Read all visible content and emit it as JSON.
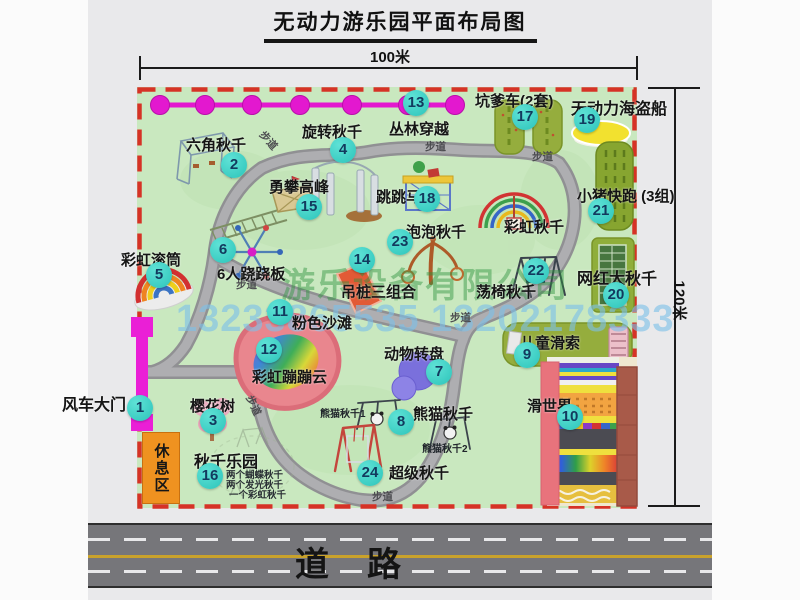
{
  "page": {
    "title": "无动力游乐园平面布局图"
  },
  "dimensions": {
    "width_label": "100米",
    "height_label": "120米"
  },
  "road": {
    "label": "道路"
  },
  "walkway_label": "步道",
  "watermark": {
    "company": "游乐设备有限公司",
    "phone": "13233865535 13202178333"
  },
  "colors": {
    "map_fill": "#c9e8bf",
    "border_dash": "#d63226",
    "badge": "#3fd6c8",
    "zipline": "#e318cf",
    "gate": "#ea1fd6",
    "road_line": "#c9a22b",
    "rest_area": "#ef9220"
  },
  "attractions": [
    {
      "num": "1",
      "name": "风车大门"
    },
    {
      "num": "2",
      "name": "六角秋千"
    },
    {
      "num": "3",
      "name": "樱花树"
    },
    {
      "num": "4",
      "name": "旋转秋千"
    },
    {
      "num": "5",
      "name": "彩虹滚筒"
    },
    {
      "num": "6",
      "name": "6人跷跷板"
    },
    {
      "num": "7",
      "name": "动物转盘"
    },
    {
      "num": "8",
      "name": "熊猫秋千"
    },
    {
      "num": "9",
      "name": "儿童滑索"
    },
    {
      "num": "10",
      "name": "滑世界"
    },
    {
      "num": "11",
      "name": "粉色沙滩"
    },
    {
      "num": "12",
      "name": "彩虹蹦蹦云"
    },
    {
      "num": "13",
      "name": "丛林穿越"
    },
    {
      "num": "14",
      "name": "吊桩三组合"
    },
    {
      "num": "15",
      "name": "勇攀高峰"
    },
    {
      "num": "16",
      "name": "秋千乐园"
    },
    {
      "num": "17",
      "name": "坑爹车(2套)"
    },
    {
      "num": "18",
      "name": "跳跳马"
    },
    {
      "num": "19",
      "name": "无动力海盗船"
    },
    {
      "num": "20",
      "name": "网红大秋千"
    },
    {
      "num": "21",
      "name": "小猪快跑 (3组)"
    },
    {
      "num": "22",
      "name": "荡椅秋千"
    },
    {
      "num": "23",
      "name": "泡泡秋千"
    },
    {
      "num": "24",
      "name": "超级秋千"
    }
  ],
  "extra_labels": {
    "rainbow_swing": "彩虹秋千",
    "panda1": "熊猫秋千1",
    "panda2": "熊猫秋千2",
    "rest_area": "休息区",
    "swing_park_notes": [
      "两个蝴蝶秋千",
      "两个发光秋千",
      "一个彩虹秋千"
    ]
  }
}
